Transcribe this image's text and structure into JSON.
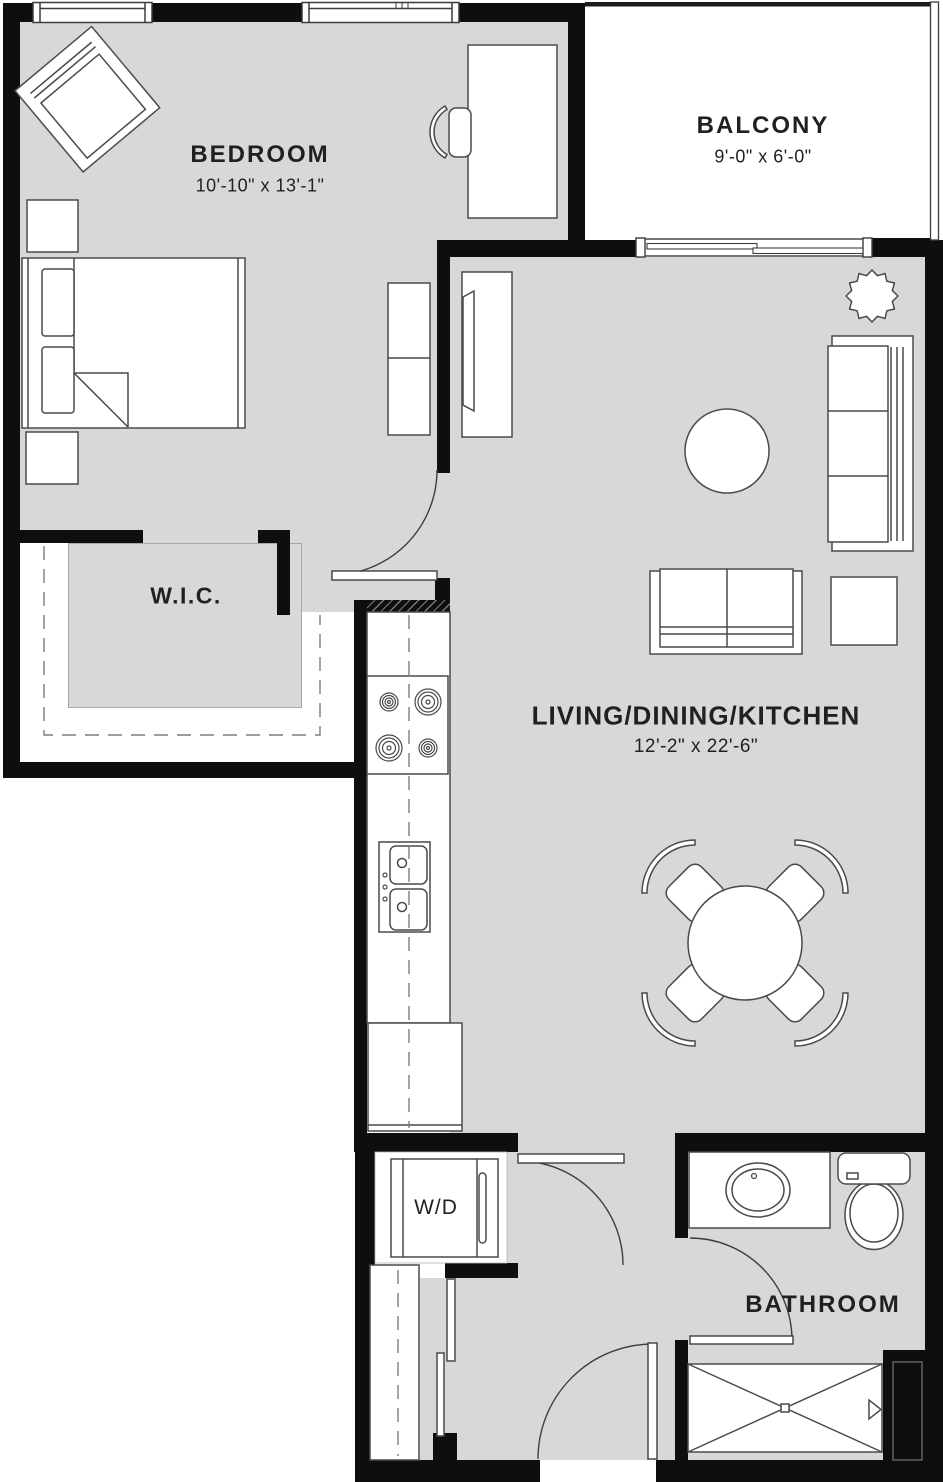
{
  "plan": {
    "rooms": {
      "bedroom": {
        "name": "BEDROOM",
        "dims": "10'-10\" x 13'-1\""
      },
      "balcony": {
        "name": "BALCONY",
        "dims": "9'-0\" x 6'-0\""
      },
      "wic": {
        "name": "W.I.C."
      },
      "living": {
        "name": "LIVING/DINING/KITCHEN",
        "dims": "12'-2\" x 22'-6\""
      },
      "bathroom": {
        "name": "BATHROOM"
      },
      "laundry": {
        "name": "W/D"
      }
    },
    "colors": {
      "floor": "#d8d8d8",
      "wall": "#0e0e0e",
      "line": "#4a4a4c",
      "text": "#231f20"
    }
  }
}
